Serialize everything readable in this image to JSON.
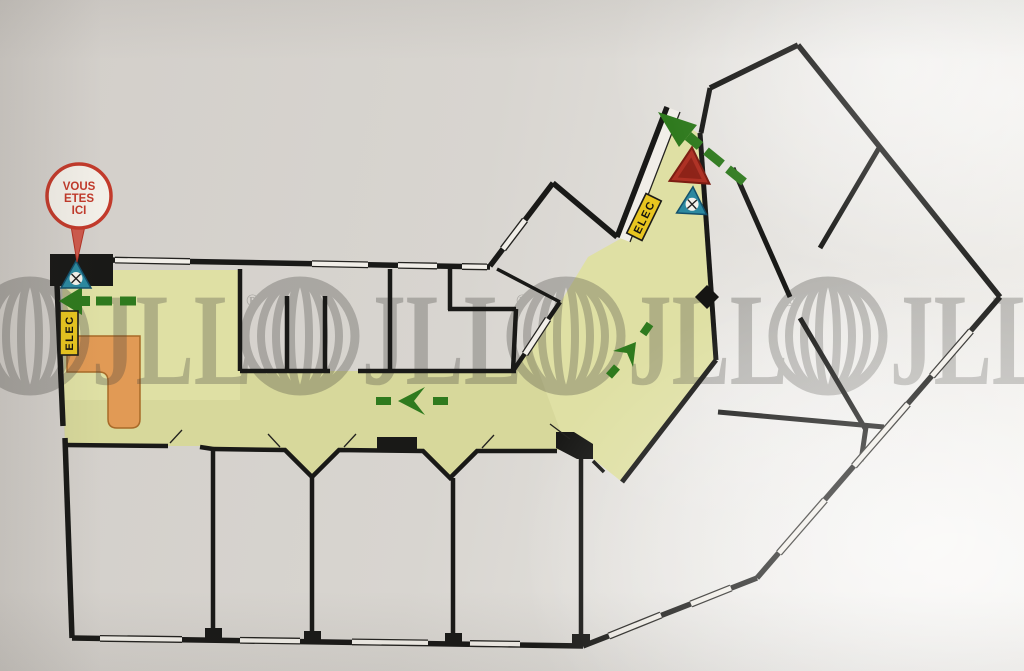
{
  "title": "evacuation-floor-plan-photo",
  "you_are_here": {
    "line1": "VOUS",
    "line2": "ETES",
    "line3": "ICI"
  },
  "labels": {
    "elec": "ELEC"
  },
  "watermark": {
    "text": "JLL",
    "registered": "®",
    "count": 4
  },
  "icons": {
    "marker": "you-are-here-balloon",
    "extinguisher": "fire-extinguisher-triangle-icon",
    "alarm": "fire-alarm-triangle-icon",
    "column": "column-diamond-marker",
    "stairs": "stairs-block"
  },
  "route": {
    "arrow_count": 4,
    "directions": [
      "left-exit-top-left",
      "left-mid-corridor",
      "up-right-mid-corridor",
      "up-left-top-exit"
    ]
  },
  "colors": {
    "paper": "#d8d4cf",
    "corridor_fill": "#dfe0a4",
    "wall": "#191917",
    "stairs_orange": "#e19a55",
    "arrow_green": "#2f7a1e",
    "elec_bg": "#e8c51f",
    "alarm_red": "#ae3124",
    "extinguisher_teal": "#2c89a0",
    "marker_red": "#c23a2b",
    "watermark_gray": "#45443f"
  }
}
